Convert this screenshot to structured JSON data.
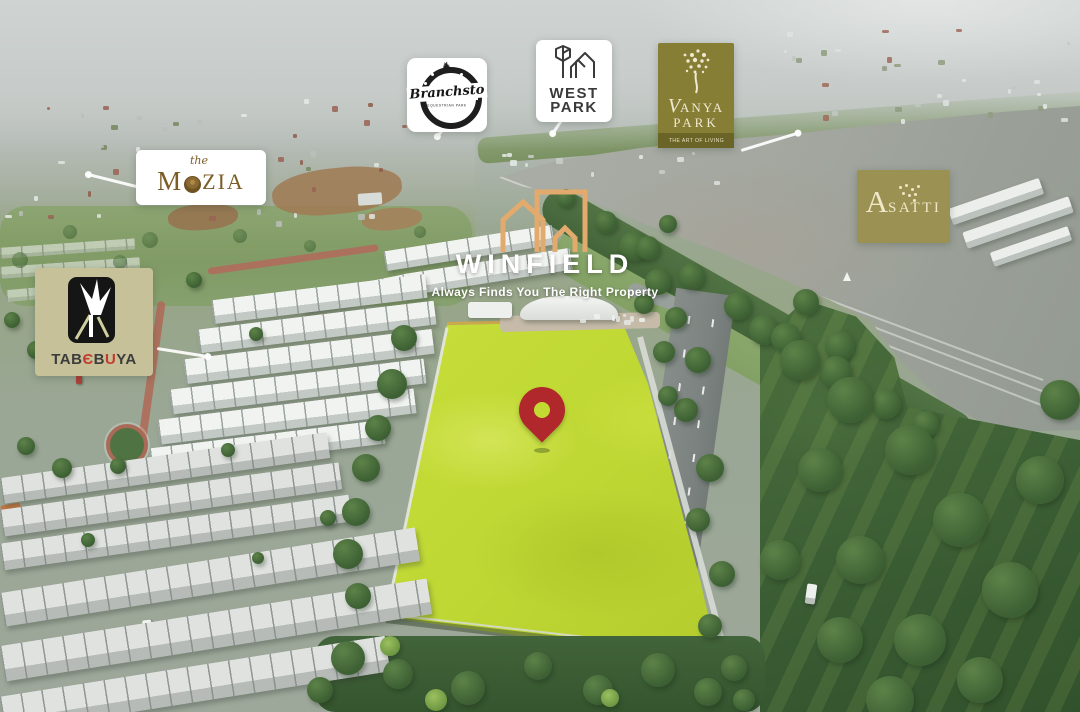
{
  "brands": {
    "branchsto": {
      "name": "Branchsto",
      "subtitle": "EQUESTRIAN PARK"
    },
    "west_park": {
      "line1": "WEST",
      "line2": "PARK"
    },
    "vanya_park": {
      "line1": "V",
      "line1_rest": "ANYA",
      "line2": "PARK",
      "tagline": "THE ART OF LIVING",
      "bg_color": "#867e35",
      "band_color": "#6a6527"
    },
    "mozia": {
      "pre": "the",
      "m": "M",
      "zia": "ZIA",
      "text_color": "#7c5d26"
    },
    "winfield": {
      "name": "WINFIELD",
      "tagline": "Always Finds You The Right Property",
      "icon_color": "#e3aa6e"
    },
    "asatti": {
      "initial": "A",
      "rest": "SATTI",
      "bg_color": "#9a9152"
    },
    "tabebuya": {
      "bg_color": "#c6c198",
      "accent_color": "#c33b2e",
      "segments": [
        {
          "t": "TAB"
        },
        {
          "t": "Є"
        },
        {
          "t": "B"
        },
        {
          "t": "U"
        },
        {
          "t": "YA"
        }
      ]
    }
  },
  "marker": {
    "color": "#b0282c"
  },
  "site": {
    "plot_highlight_color": "#c3da33"
  }
}
